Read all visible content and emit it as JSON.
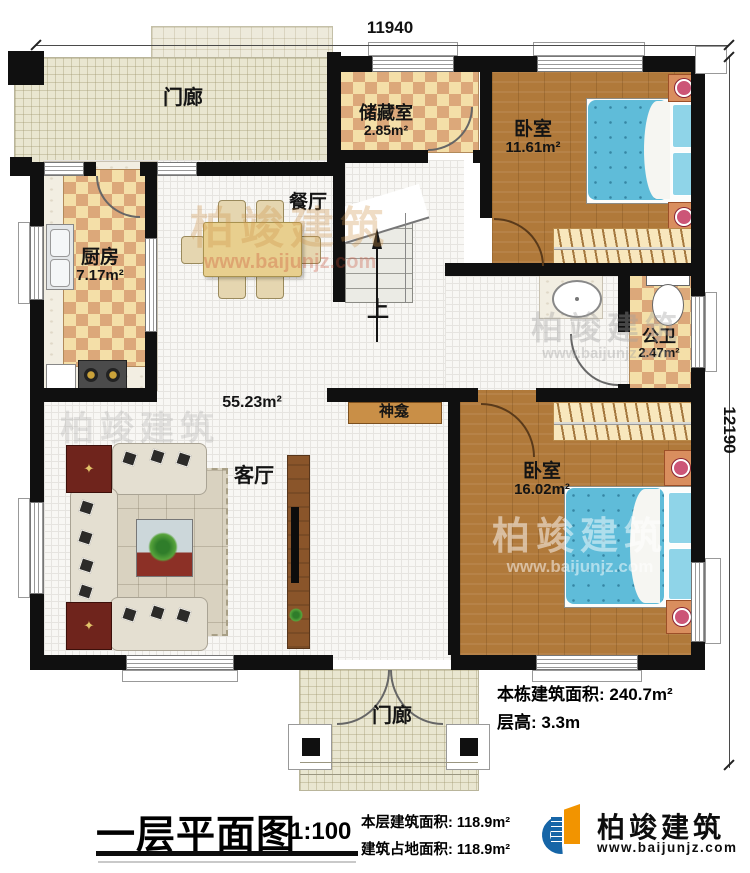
{
  "dimensions": {
    "top": "11940",
    "right": "12190"
  },
  "rooms": {
    "porch_top": {
      "name": "门廊"
    },
    "kitchen": {
      "name": "厨房",
      "area": "7.17m²"
    },
    "dining": {
      "name": "餐厅"
    },
    "storage": {
      "name": "储藏室",
      "area": "2.85m²"
    },
    "bedroom_top": {
      "name": "卧室",
      "area": "11.61m²"
    },
    "bathroom": {
      "name": "公卫",
      "area": "2.47m²"
    },
    "hall": {
      "area": "55.23m²"
    },
    "living": {
      "name": "客厅"
    },
    "shrine": {
      "name": "神龛"
    },
    "bedroom_bottom": {
      "name": "卧室",
      "area": "16.02m²"
    },
    "stairs": {
      "direction": "上"
    },
    "porch_bottom": {
      "name": "门廊"
    }
  },
  "annotations": {
    "line1": "本栋建筑面积: 240.7m²",
    "line2": "层高: 3.3m"
  },
  "footer": {
    "title": "一层平面图",
    "scale": "1:100",
    "line1": "本层建筑面积: 118.9m²",
    "line2": "建筑占地面积: 118.9m²",
    "brand": "柏竣建筑",
    "website": "www.baijunjz.com"
  },
  "watermark": {
    "brand": "柏竣建筑",
    "website": "www.baijunjz.com"
  },
  "colors": {
    "wall": "#101010",
    "checker_light": "#f4dfa8",
    "checker_dark": "#dca87a",
    "wood_floor": "#b0793a",
    "porch_floor": "#e9e6d0",
    "bed": "#5fbcd9",
    "brand_blue": "#1665a7",
    "brand_orange": "#f29400"
  }
}
